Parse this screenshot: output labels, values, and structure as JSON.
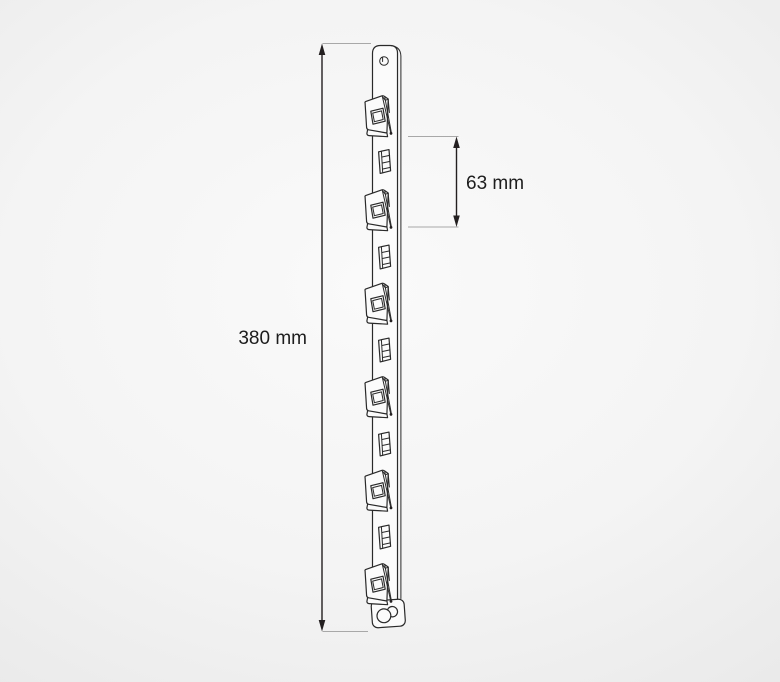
{
  "diagram": {
    "type": "technical-drawing",
    "subject": "display clip strip",
    "dimensions": [
      {
        "name": "overall-height",
        "label": "380 mm",
        "value": 380,
        "unit": "mm"
      },
      {
        "name": "clip-spacing",
        "label": "63 mm",
        "value": 63,
        "unit": "mm"
      }
    ],
    "counts": {
      "clips": 6,
      "slots": 5,
      "hanging_holes": 1,
      "bottom_studs": 1
    }
  },
  "colors": {
    "drawing_line": "#2a2a2a",
    "dimension_line": "#231f20",
    "extension_line": "#a8a8a8",
    "label_text": "#1d1d1d",
    "background_center": "#fafafa",
    "background_edge": "#e8e8e8"
  }
}
